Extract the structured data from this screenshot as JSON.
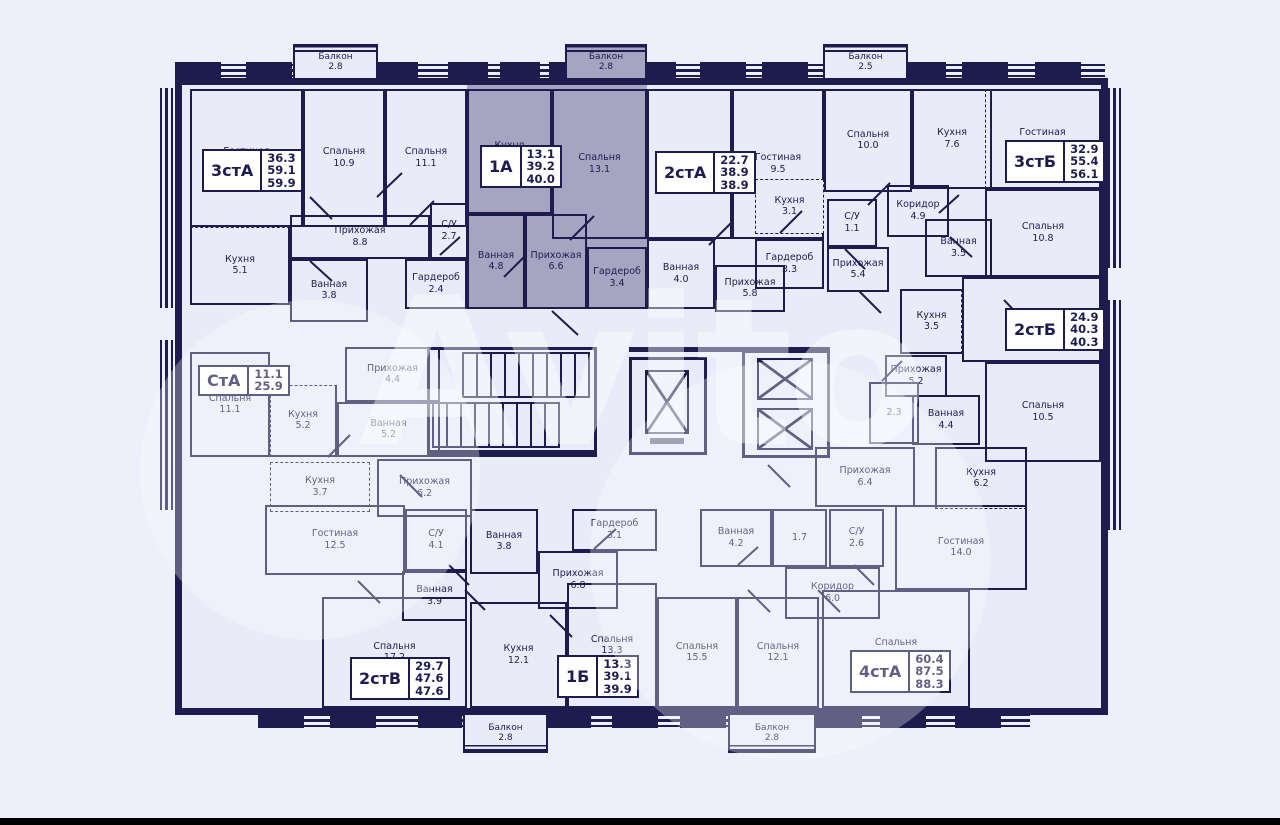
{
  "watermark": "Avito",
  "colors": {
    "wall": "#1e1c4f",
    "floor": "#e9ebf8",
    "background": "#edeffb",
    "highlight_unit": "#a6a4c0",
    "label_box": "#ffffff"
  },
  "units": {
    "u3stA": {
      "code": "3стА",
      "values": [
        "36.3",
        "59.1",
        "59.9"
      ]
    },
    "u1A": {
      "code": "1А",
      "values": [
        "13.1",
        "39.2",
        "40.0"
      ]
    },
    "u2stA": {
      "code": "2стА",
      "values": [
        "22.7",
        "38.9",
        "38.9"
      ]
    },
    "u3stB": {
      "code": "3стБ",
      "values": [
        "32.9",
        "55.4",
        "56.1"
      ]
    },
    "u2stB": {
      "code": "2стБ",
      "values": [
        "24.9",
        "40.3",
        "40.3"
      ]
    },
    "uStA": {
      "code": "СтА",
      "values": [
        "11.1",
        "25.9"
      ]
    },
    "u2stV": {
      "code": "2стВ",
      "values": [
        "29.7",
        "47.6",
        "47.6"
      ]
    },
    "u1B": {
      "code": "1Б",
      "values": [
        "13.3",
        "39.1",
        "39.9"
      ]
    },
    "u4stA": {
      "code": "4стА",
      "values": [
        "60.4",
        "87.5",
        "88.3"
      ]
    }
  },
  "rooms": {
    "living_14_3": {
      "name": "Гостиная",
      "area": "14.3"
    },
    "bed_10_9": {
      "name": "Спальня",
      "area": "10.9"
    },
    "bed_11_1": {
      "name": "Спальня",
      "area": "11.1"
    },
    "kitchen_5_1": {
      "name": "Кухня",
      "area": "5.1"
    },
    "hall_8_8": {
      "name": "Прихожая",
      "area": "8.8"
    },
    "bath_3_8": {
      "name": "Ванная",
      "area": "3.8"
    },
    "wc_2_7": {
      "name": "С/У",
      "area": "2.7"
    },
    "ward_2_4": {
      "name": "Гардероб",
      "area": "2.4"
    },
    "kitchen_11_3": {
      "name": "Кухня",
      "area": "11.3"
    },
    "bed_13_1": {
      "name": "Спальня",
      "area": "13.1"
    },
    "bath_4_8": {
      "name": "Ванная",
      "area": "4.8"
    },
    "hall_6_6": {
      "name": "Прихожая",
      "area": "6.6"
    },
    "ward_3_4": {
      "name": "Гардероб",
      "area": "3.4"
    },
    "bed_13_2": {
      "name": "Спальня",
      "area": "13.2"
    },
    "living_9_5": {
      "name": "Гостиная",
      "area": "9.5"
    },
    "kitchen_3_1": {
      "name": "Кухня",
      "area": "3.1"
    },
    "wc_1_1": {
      "name": "С/У",
      "area": "1.1"
    },
    "bath_4_0": {
      "name": "Ванная",
      "area": "4.0"
    },
    "ward_3_3": {
      "name": "Гардероб",
      "area": "3.3"
    },
    "hall_5_8": {
      "name": "Прихожая",
      "area": "5.8"
    },
    "hall_5_4": {
      "name": "Прихожая",
      "area": "5.4"
    },
    "bed_10_0": {
      "name": "Спальня",
      "area": "10.0"
    },
    "kitchen_7_6": {
      "name": "Кухня",
      "area": "7.6"
    },
    "living_12_1": {
      "name": "Гостиная",
      "area": "12.1"
    },
    "corridor_4_9": {
      "name": "Коридор",
      "area": "4.9"
    },
    "bath_3_5": {
      "name": "Ванная",
      "area": "3.5"
    },
    "bed_10_8": {
      "name": "Спальня",
      "area": "10.8"
    },
    "living_14_4": {
      "name": "Гостиная",
      "area": "14.4"
    },
    "kitchen_3_5b": {
      "name": "Кухня",
      "area": "3.5"
    },
    "hall_5_2b": {
      "name": "Прихожая",
      "area": "5.2"
    },
    "bath_4_4b": {
      "name": "Ванная",
      "area": "4.4"
    },
    "bed_10_5": {
      "name": "Спальня",
      "area": "10.5"
    },
    "kitchen_6_2b": {
      "name": "Кухня",
      "area": "6.2"
    },
    "room_2_3": {
      "name": "",
      "area": "2.3"
    },
    "hall_6_4": {
      "name": "Прихожая",
      "area": "6.4"
    },
    "bed_11_1b": {
      "name": "Спальня",
      "area": "11.1"
    },
    "kitchen_5_2": {
      "name": "Кухня",
      "area": "5.2"
    },
    "hall_4_4": {
      "name": "Прихожая",
      "area": "4.4"
    },
    "bath_5_2": {
      "name": "Ванная",
      "area": "5.2"
    },
    "kitchen_3_7": {
      "name": "Кухня",
      "area": "3.7"
    },
    "hall_6_2": {
      "name": "Прихожая",
      "area": "6.2"
    },
    "living_12_5": {
      "name": "Гостиная",
      "area": "12.5"
    },
    "wc_4_1": {
      "name": "С/У",
      "area": "4.1"
    },
    "bath_3_9": {
      "name": "Ванная",
      "area": "3.9"
    },
    "bed_17_2": {
      "name": "Спальня",
      "area": "17.2"
    },
    "bath_3_8b": {
      "name": "Ванная",
      "area": "3.8"
    },
    "hall_6_8": {
      "name": "Прихожая",
      "area": "6.8"
    },
    "ward_3_1b": {
      "name": "Гардероб",
      "area": "3.1"
    },
    "kitchen_12_1": {
      "name": "Кухня",
      "area": "12.1"
    },
    "bed_13_3": {
      "name": "Спальня",
      "area": "13.3"
    },
    "bed_15_5": {
      "name": "Спальня",
      "area": "15.5"
    },
    "bed_12_1": {
      "name": "Спальня",
      "area": "12.1"
    },
    "bath_4_2": {
      "name": "Ванная",
      "area": "4.2"
    },
    "room_1_7": {
      "name": "",
      "area": "1.7"
    },
    "wc_2_6": {
      "name": "С/У",
      "area": "2.6"
    },
    "corridor_6_0": {
      "name": "Коридор",
      "area": "6.0"
    },
    "bed_18_8": {
      "name": "Спальня",
      "area": "18.8"
    },
    "living_14_0": {
      "name": "Гостиная",
      "area": "14.0"
    }
  },
  "balconies": {
    "top_left": {
      "name": "Балкон",
      "area": "2.8"
    },
    "top_mid": {
      "name": "Балкон",
      "area": "2.8"
    },
    "top_right": {
      "name": "Балкон",
      "area": "2.5"
    },
    "bottom_left": {
      "name": "Балкон",
      "area": "2.8"
    },
    "bottom_right": {
      "name": "Балкон",
      "area": "2.8"
    }
  }
}
